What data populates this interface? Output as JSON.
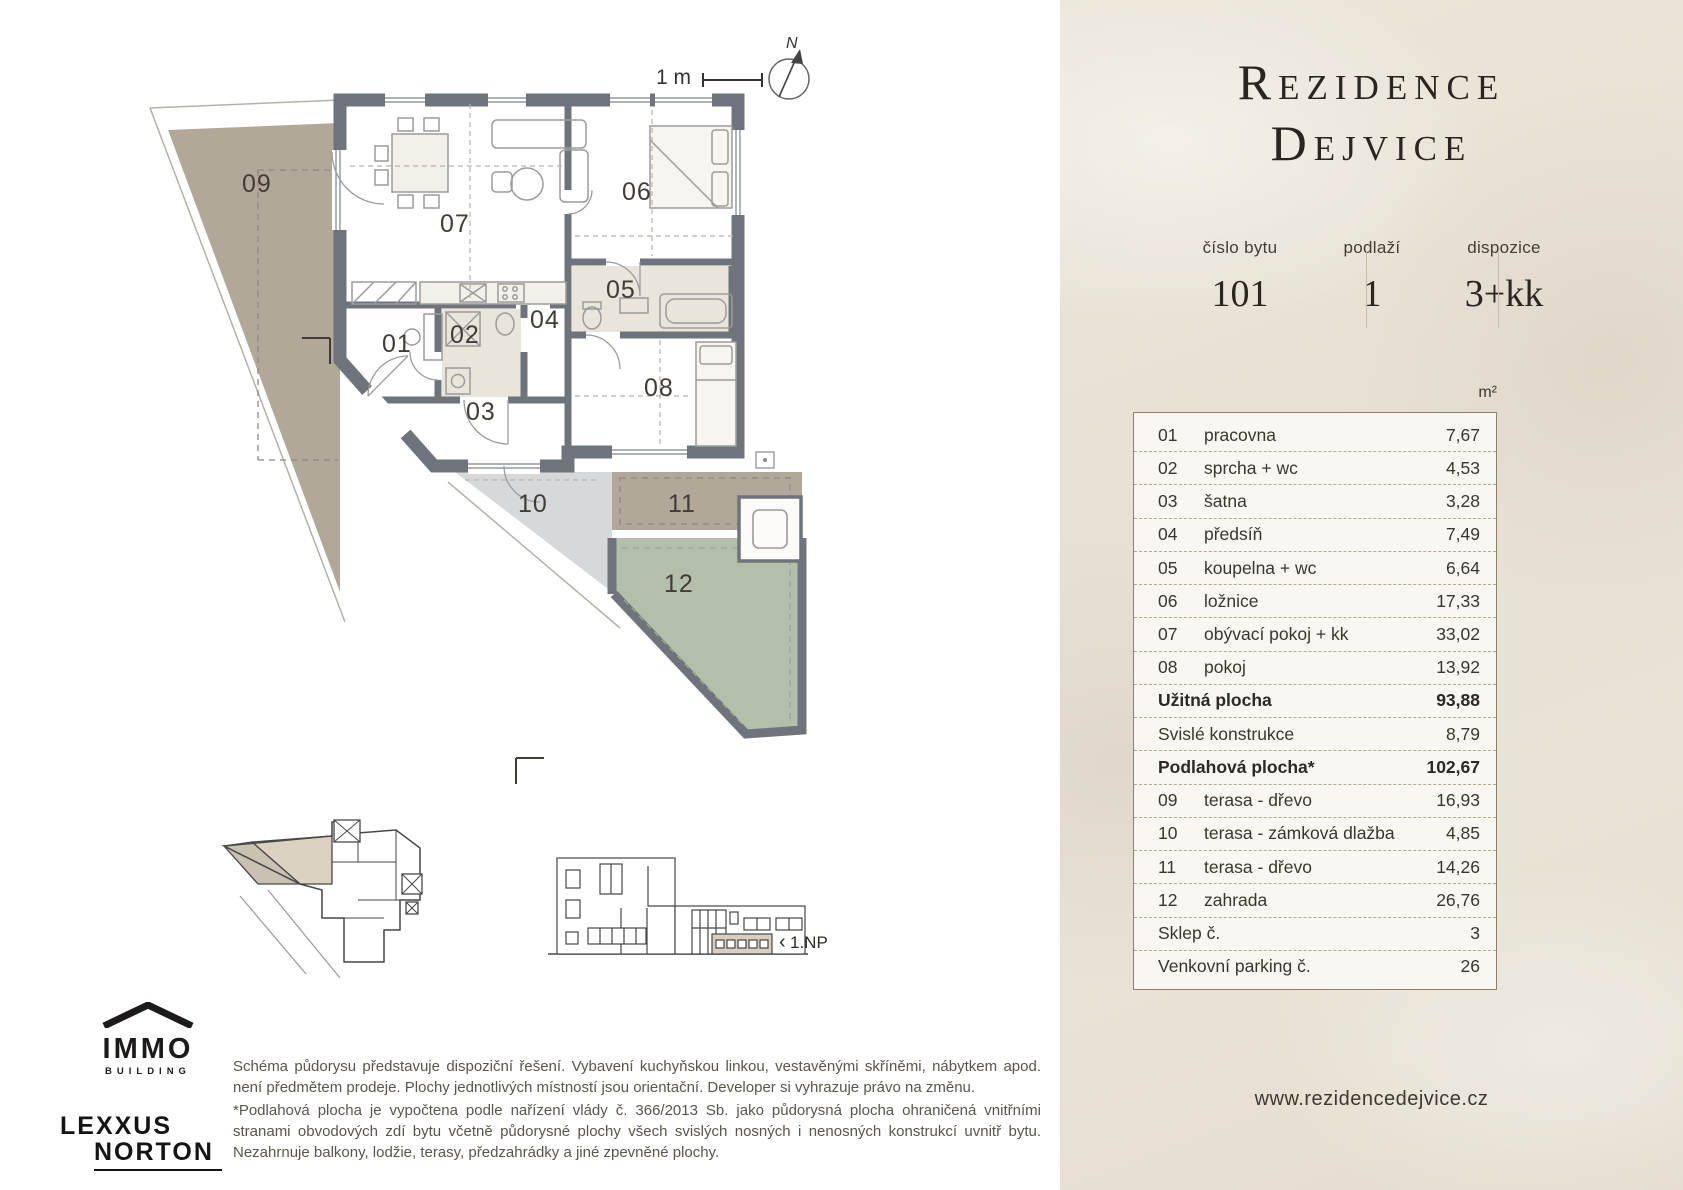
{
  "plan": {
    "scale_label": "1 m",
    "north_label": "N",
    "room_labels": {
      "r01": "01",
      "r02": "02",
      "r03": "03",
      "r04": "04",
      "r05": "05",
      "r06": "06",
      "r07": "07",
      "r08": "08",
      "r09": "09",
      "r10": "10",
      "r11": "11",
      "r12": "12"
    },
    "floor_indicator": {
      "arrow": "‹",
      "label": "1.NP"
    }
  },
  "logos": {
    "immo_line1": "IMMO",
    "immo_line2": "BUILDING",
    "lexxus_line1": "LEXXUS",
    "lexxus_line2": "NORTON"
  },
  "disclaimer": {
    "paragraph1": "Schéma půdorysu představuje dispoziční řešení. Vybavení kuchyňskou linkou, vestavěnými skříněmi, nábytkem apod. není předmětem prodeje. Plochy jednotlivých místností jsou orientační. Developer si vyhrazuje právo na změnu.",
    "paragraph2": "*Podlahová plocha je vypočtena podle nařízení vlády č. 366/2013 Sb. jako půdorysná plocha ohraničená vnitřními stranami obvodových zdí bytu včetně půdorysné plochy všech svislých nosných i nenosných konstrukcí uvnitř bytu. Nezahrnuje balkony, lodžie, terasy, předzahrádky a jiné zpevněné plochy."
  },
  "panel": {
    "title_line1": "Rezidence",
    "title_line2": "Dejvice",
    "info": [
      {
        "label": "číslo bytu",
        "value": "101"
      },
      {
        "label": "podlaží",
        "value": "1"
      },
      {
        "label": "dispozice",
        "value": "3+kk"
      }
    ],
    "unit_header": "m²",
    "table": {
      "rows": [
        {
          "num": "01",
          "name": "pracovna",
          "value": "7,67",
          "bold": false
        },
        {
          "num": "02",
          "name": "sprcha + wc",
          "value": "4,53",
          "bold": false
        },
        {
          "num": "03",
          "name": "šatna",
          "value": "3,28",
          "bold": false
        },
        {
          "num": "04",
          "name": "předsíň",
          "value": "7,49",
          "bold": false
        },
        {
          "num": "05",
          "name": "koupelna + wc",
          "value": "6,64",
          "bold": false
        },
        {
          "num": "06",
          "name": "ložnice",
          "value": "17,33",
          "bold": false
        },
        {
          "num": "07",
          "name": "obývací pokoj + kk",
          "value": "33,02",
          "bold": false
        },
        {
          "num": "08",
          "name": "pokoj",
          "value": "13,92",
          "bold": false
        },
        {
          "num": "",
          "name": "Užitná plocha",
          "value": "93,88",
          "bold": true
        },
        {
          "num": "",
          "name": "Svislé konstrukce",
          "value": "8,79",
          "bold": false
        },
        {
          "num": "",
          "name": "Podlahová plocha*",
          "value": "102,67",
          "bold": true
        },
        {
          "num": "09",
          "name": "terasa - dřevo",
          "value": "16,93",
          "bold": false
        },
        {
          "num": "10",
          "name": "terasa - zámková dlažba",
          "value": "4,85",
          "bold": false
        },
        {
          "num": "11",
          "name": "terasa - dřevo",
          "value": "14,26",
          "bold": false
        },
        {
          "num": "12",
          "name": "zahrada",
          "value": "26,76",
          "bold": false
        },
        {
          "num": "",
          "name": "Sklep č.",
          "value": "3",
          "bold": false
        },
        {
          "num": "",
          "name": "Venkovní parking č.",
          "value": "26",
          "bold": false
        }
      ]
    },
    "website": "www.rezidencedejvice.cz"
  },
  "colors": {
    "wall": "#6f747c",
    "terrace_taupe": "#b1a89a",
    "terrace_gray": "#d7d8d9",
    "garden_green": "#b3bfaa",
    "panel_bg": "#e8e2d5",
    "table_border": "#8d7e69"
  }
}
